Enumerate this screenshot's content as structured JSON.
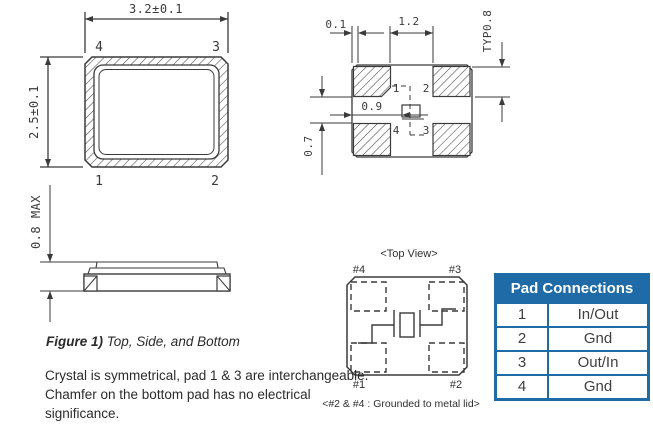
{
  "colors": {
    "line": "#3a3a3a",
    "table_blue": "#1e6ba8",
    "text": "#2b2b2b"
  },
  "fig_a": {
    "dim_w": "3.2±0.1",
    "dim_h": "2.5±0.1",
    "pads": {
      "tl": "4",
      "tr": "3",
      "bl": "1",
      "br": "2"
    }
  },
  "fig_side": {
    "dim": "0.8 MAX"
  },
  "land": {
    "dim_edge": "0.1",
    "dim_gap": "1.2",
    "dim_pad": "TYP0.8",
    "dim_center": "0.9",
    "dim_vgap": "0.7",
    "pads": {
      "tl": "1",
      "tr": "2",
      "bl": "4",
      "br": "3"
    }
  },
  "schem": {
    "title": "<Top View>",
    "pads": {
      "tl": "#4",
      "tr": "#3",
      "bl": "#1",
      "br": "#2"
    },
    "note": "<#2 & #4 : Grounded to metal lid>"
  },
  "caption": {
    "lead": "Figure 1)",
    "rest": " Top, Side, and Bottom"
  },
  "notes": {
    "line1": "Crystal is symmetrical, pad 1 & 3 are interchangeable.",
    "line2": "Chamfer on the bottom pad has no electrical",
    "line3": "significance."
  },
  "table": {
    "title": "Pad Connections",
    "rows": [
      [
        "1",
        "In/Out"
      ],
      [
        "2",
        "Gnd"
      ],
      [
        "3",
        "Out/In"
      ],
      [
        "4",
        "Gnd"
      ]
    ]
  }
}
